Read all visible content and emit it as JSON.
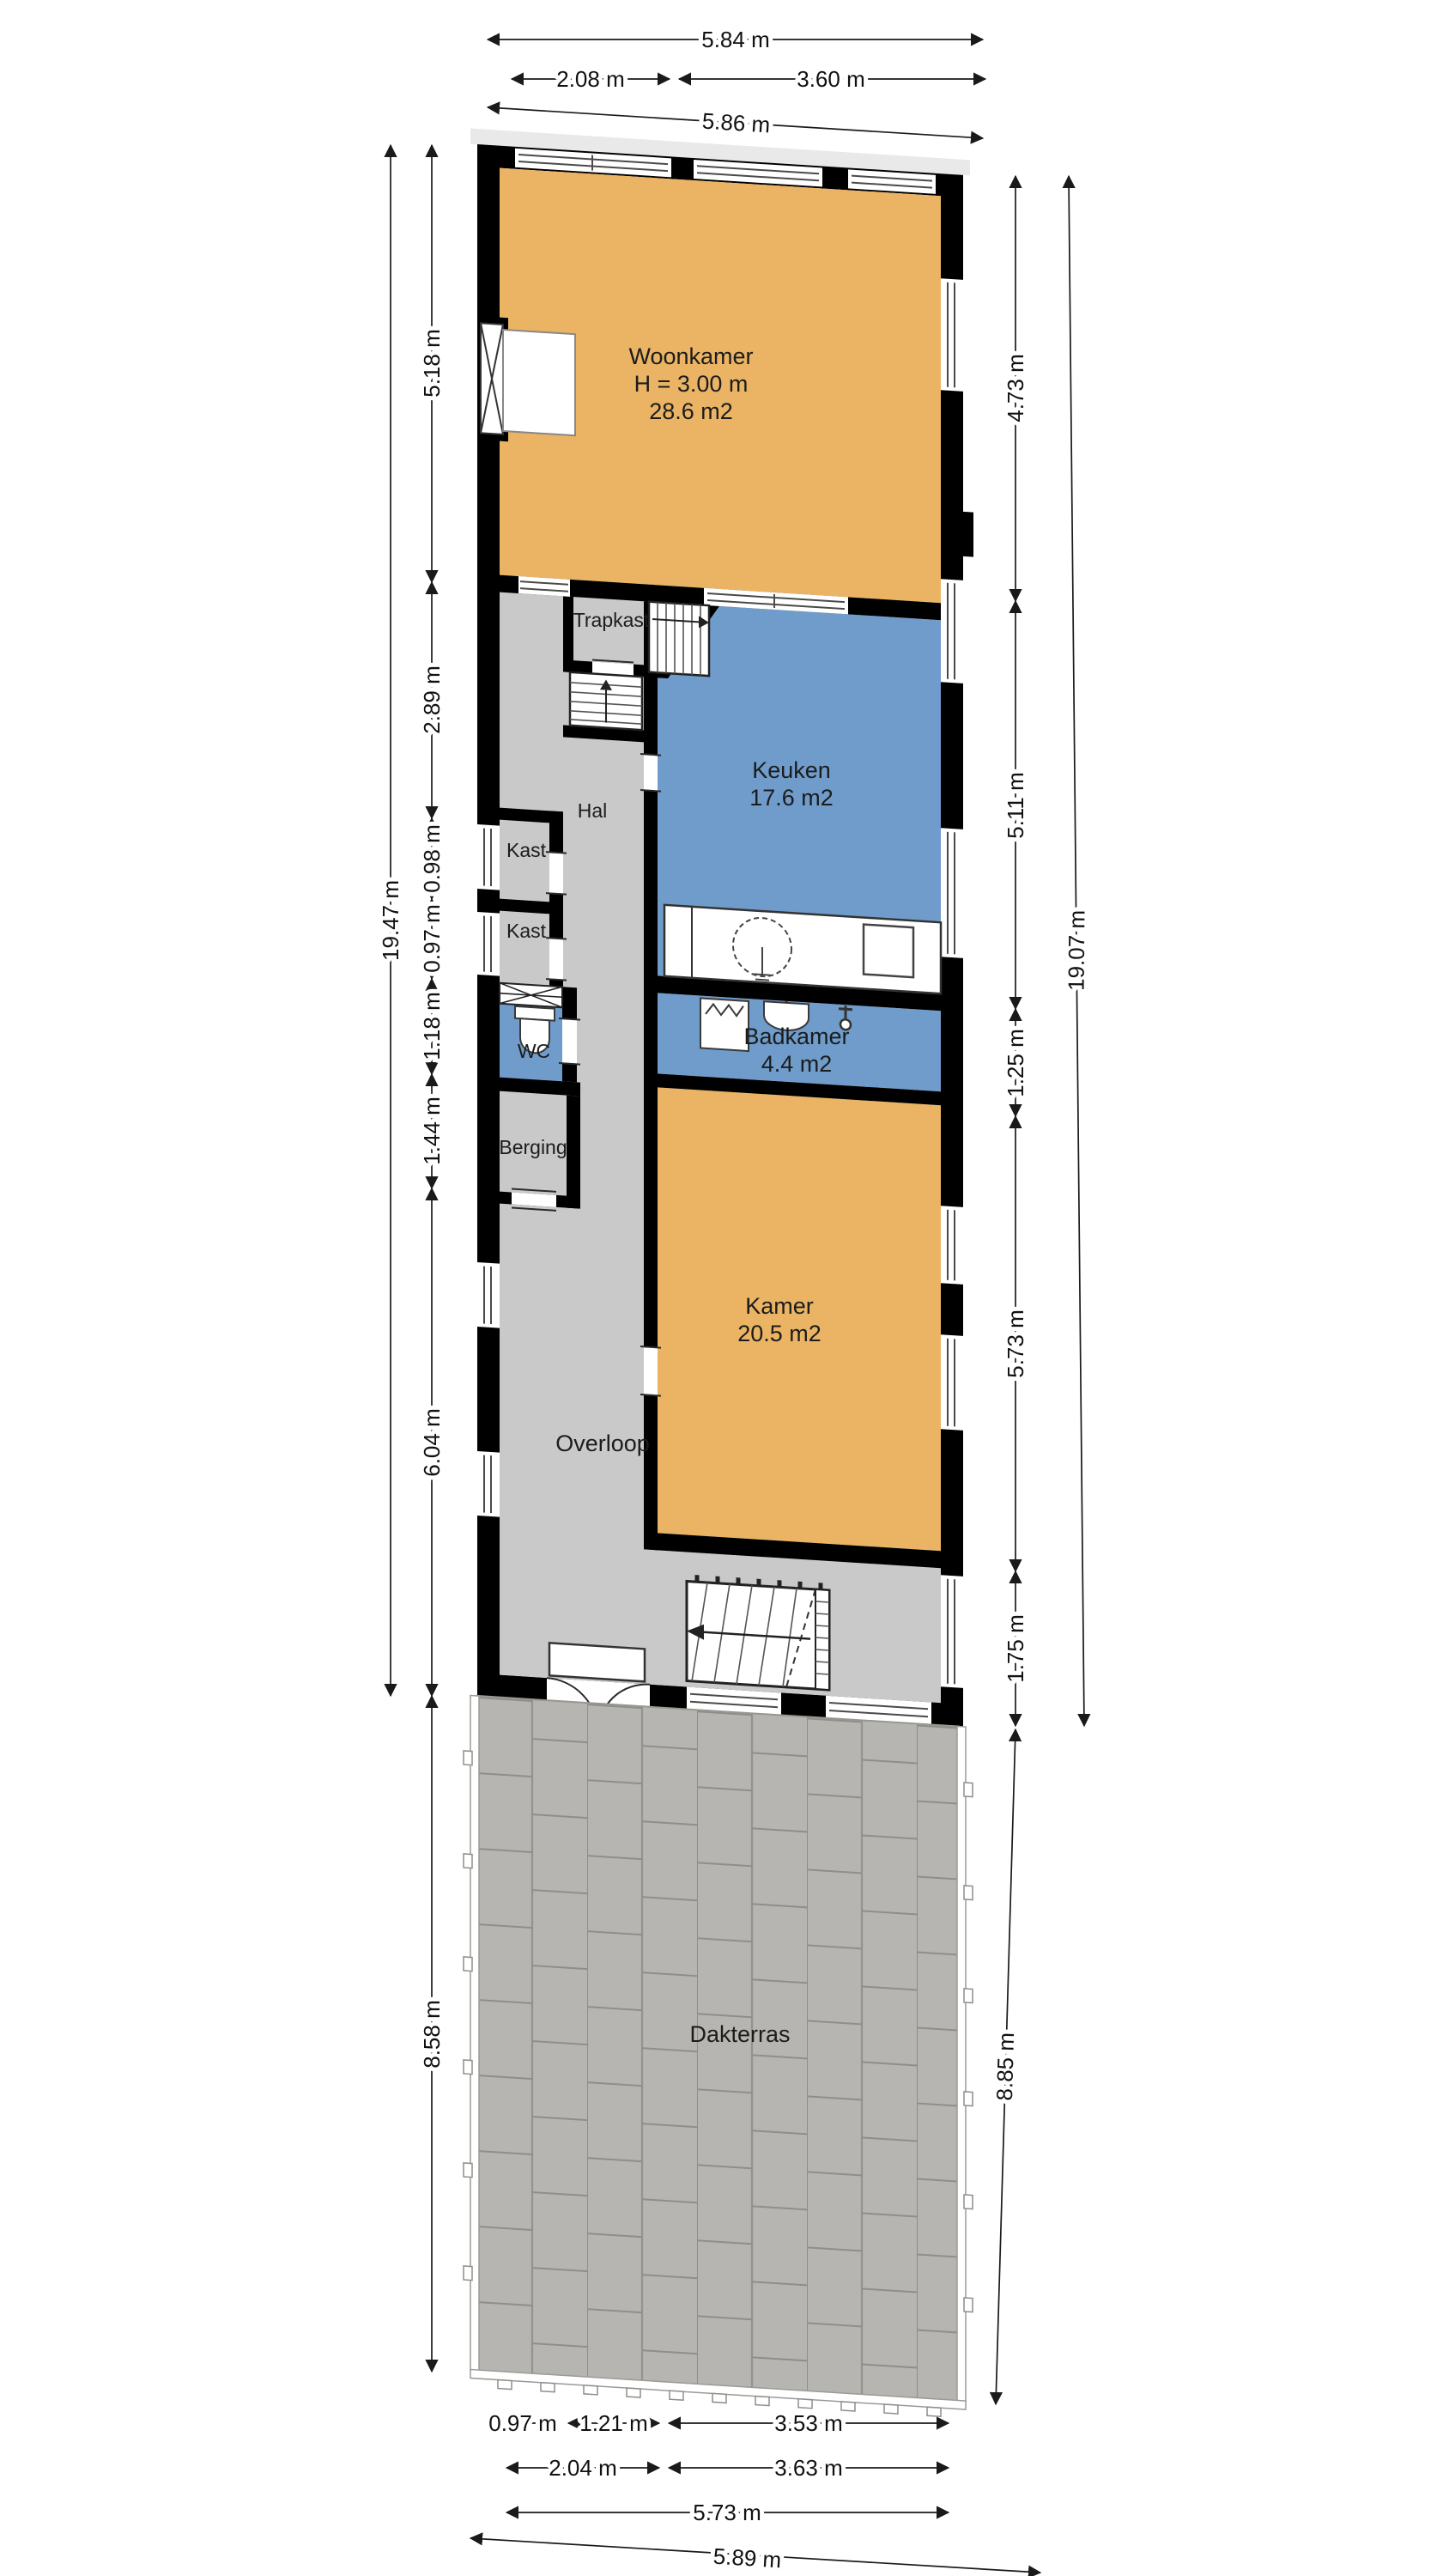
{
  "plan_title": "Floor plan with roof terrace",
  "rooms": [
    {
      "name": "Woonkamer",
      "line2": "H = 3.00 m",
      "line3": "28.6 m2"
    },
    {
      "name": "Trapkast"
    },
    {
      "name": "Keuken",
      "line2": "17.6 m2"
    },
    {
      "name": "Hal"
    },
    {
      "name": "Kast"
    },
    {
      "name": "Kast"
    },
    {
      "name": "WC"
    },
    {
      "name": "Badkamer",
      "line2": "4.4 m2"
    },
    {
      "name": "Berging"
    },
    {
      "name": "Kamer",
      "line2": "20.5 m2"
    },
    {
      "name": "Overloop"
    },
    {
      "name": "Dakterras"
    }
  ],
  "dimensions": {
    "top": [
      "5.84 m",
      "2.08 m",
      "3.60 m",
      "5.86 m"
    ],
    "left": [
      "5.18 m",
      "2.89 m",
      "0.98 m",
      "0.97 m",
      "1.18 m",
      "1.44 m",
      "6.04 m",
      "19.47 m",
      "8.58 m"
    ],
    "right": [
      "4.73 m",
      "5.11 m",
      "1.25 m",
      "5.73 m",
      "1.75 m",
      "19.07 m",
      "8.85 m"
    ],
    "bottom": [
      "0.97 m",
      "1.21 m",
      "3.53 m",
      "2.04 m",
      "3.63 m",
      "5.73 m",
      "5.89 m"
    ]
  },
  "colors": {
    "living_rooms": "#EAB464",
    "wet_rooms": "#6F9CCB",
    "circulation": "#C9C9C9",
    "walls": "#000000",
    "terrace_tile": "#B6B5B1",
    "background": "#FFFFFF"
  }
}
